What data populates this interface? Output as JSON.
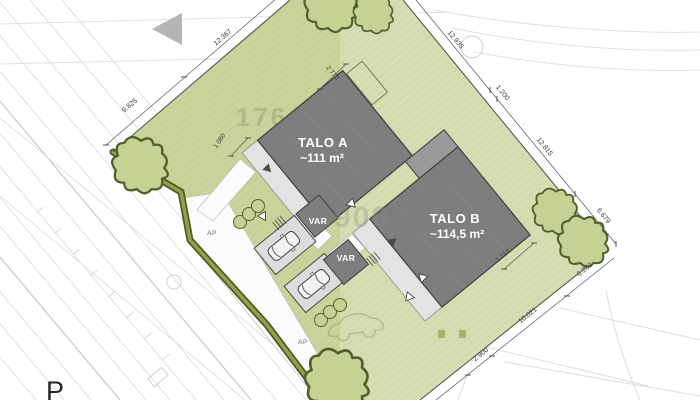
{
  "map": {
    "houses": {
      "talo_a": {
        "name": "TALO A",
        "area": "~111 m²"
      },
      "talo_b": {
        "name": "TALO B",
        "area": "~114,5 m²"
      }
    },
    "storage": {
      "var_1": "VAR",
      "var_2": "VAR"
    },
    "parking": {
      "ap_1": "AP",
      "ap_2": "AP"
    },
    "corner_label": "P",
    "dims": {
      "nw": [
        "9.825",
        "12.367"
      ],
      "ne": [
        "12.935",
        "1.200",
        "12.815",
        "6.679"
      ],
      "se": [
        "6.282",
        "10.021",
        "2.900"
      ],
      "detail": [
        "2 770",
        "1 080",
        "1 717"
      ]
    },
    "ghost": {
      "parcel": "176",
      "base": "900"
    },
    "colors": {
      "lawn": "#c9d39b",
      "lawn_light": "#e0e6c6",
      "hedge": "#6d7d35",
      "building": "#7e7e7e",
      "building_wing": "#9a9a9a",
      "terrace": "#e3e3e3",
      "paving": "#fbfbfb",
      "tree_fill": "#c6d194",
      "tree_stroke": "#51602a",
      "dim_text": "#3a3a3a"
    }
  }
}
